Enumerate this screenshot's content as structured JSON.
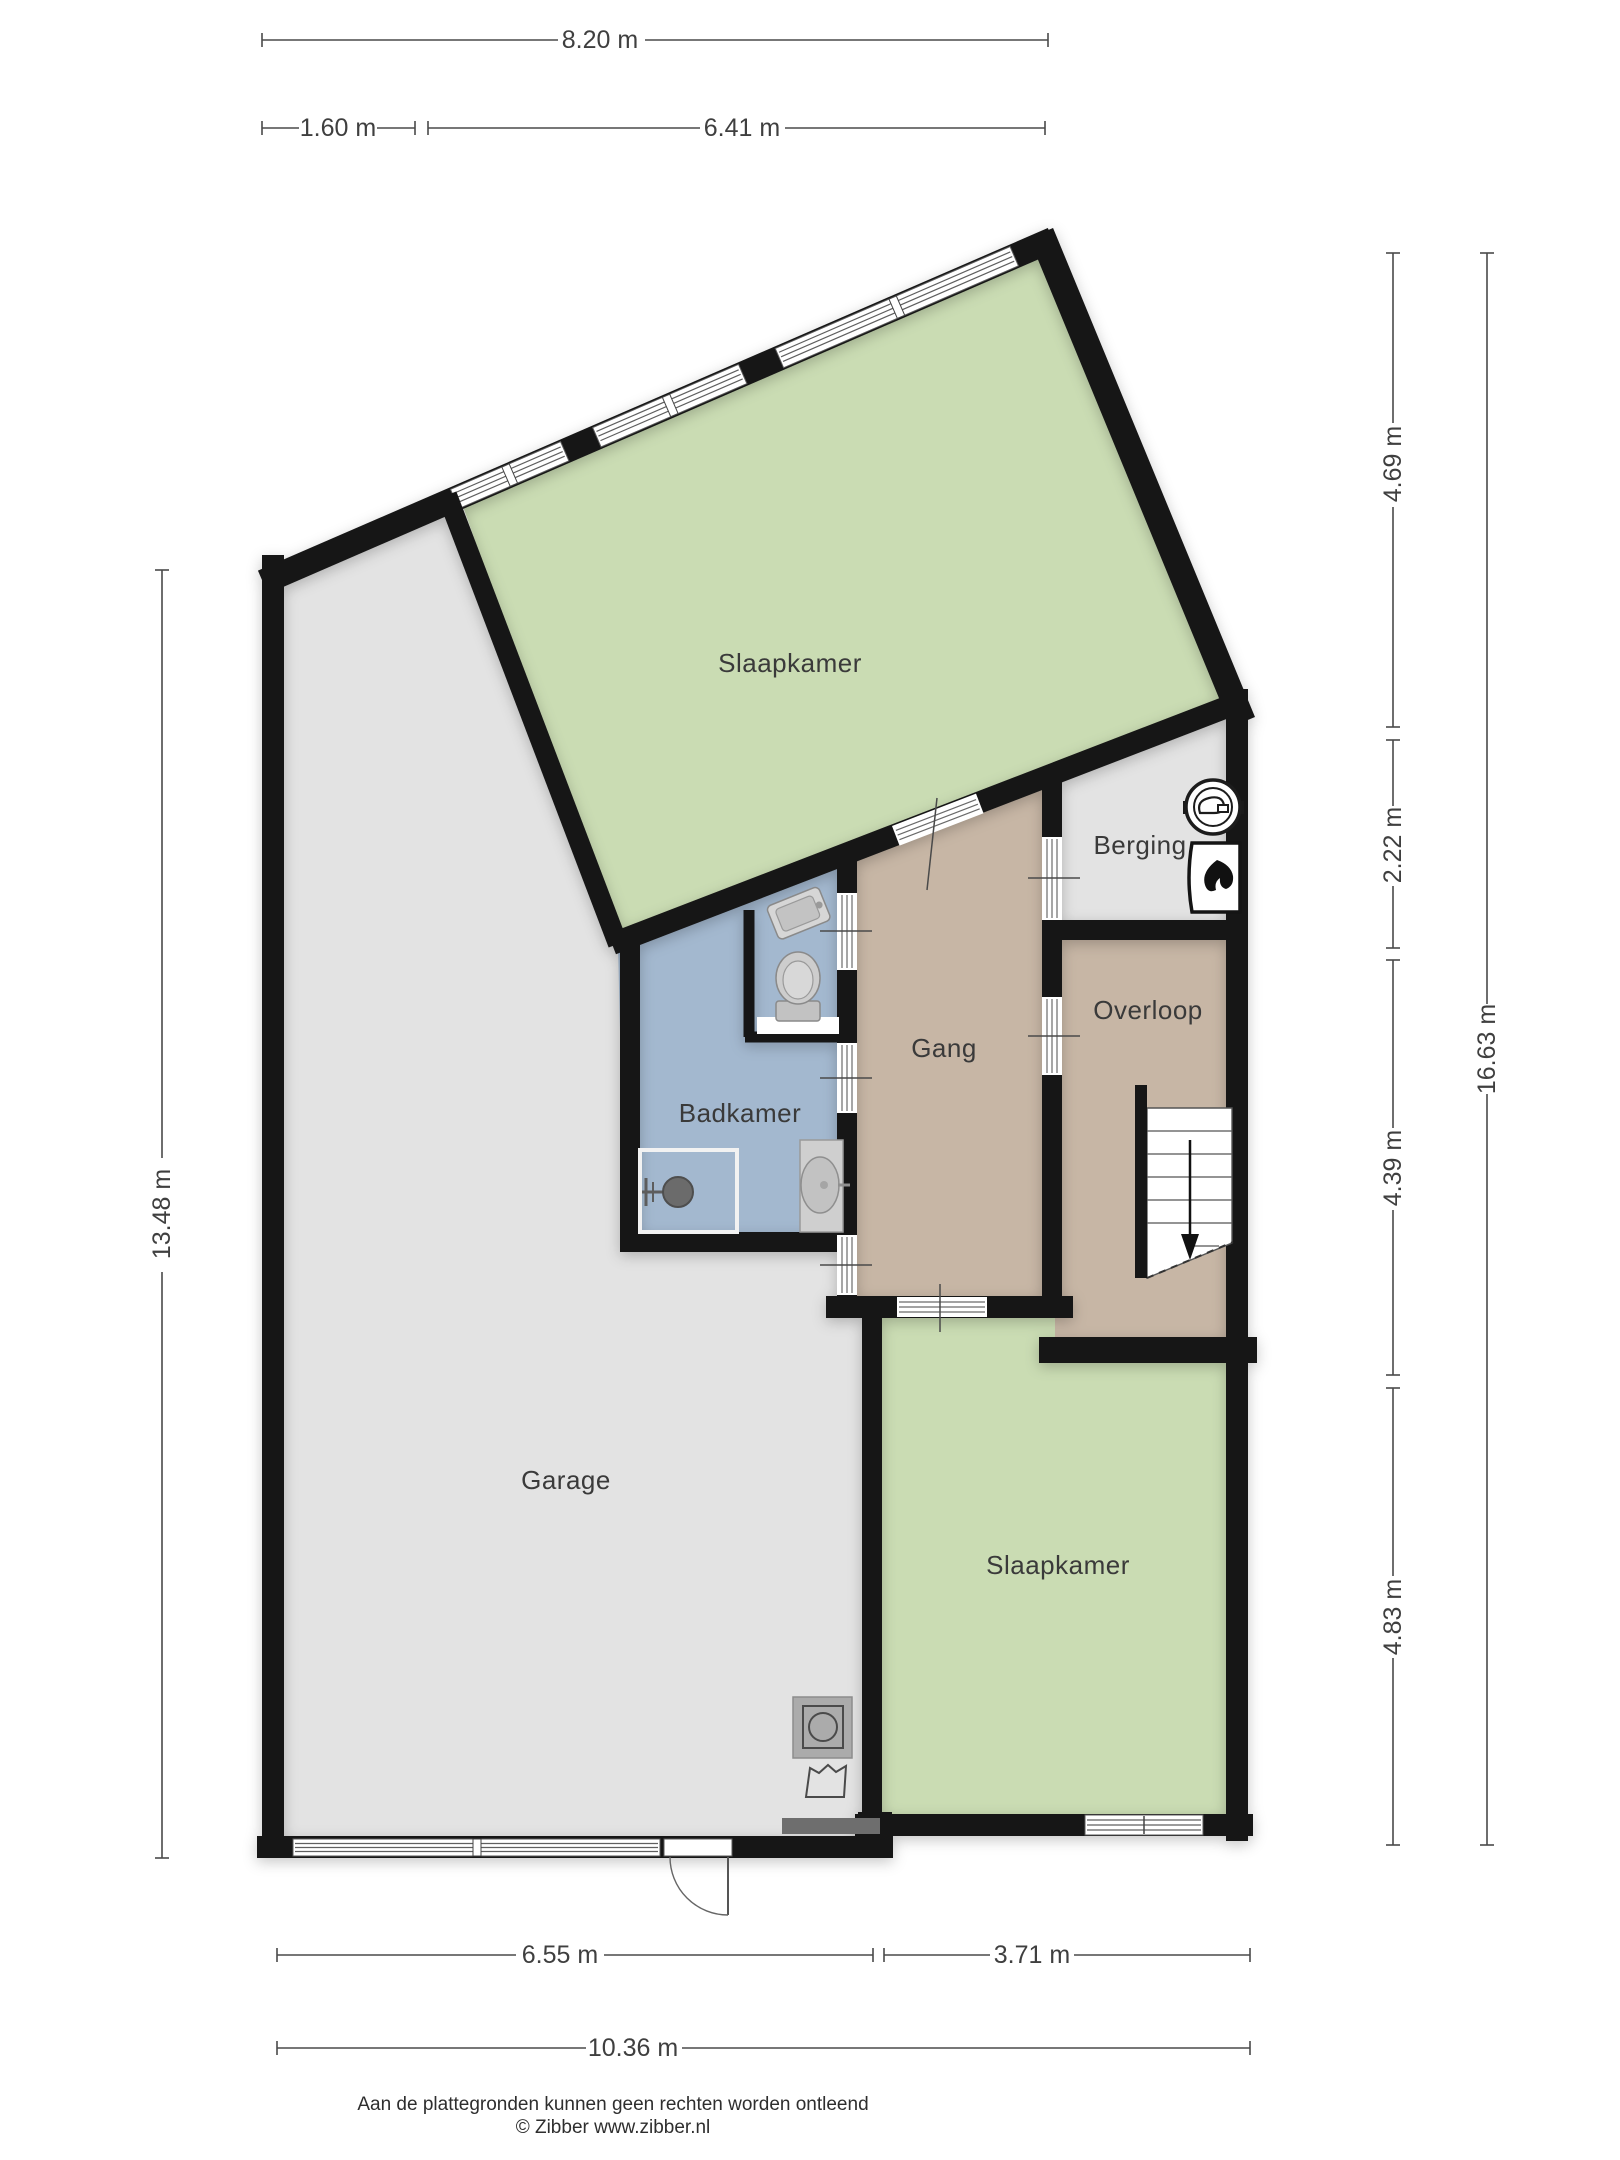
{
  "rooms": {
    "slaapkamer_top": {
      "label": "Slaapkamer"
    },
    "berging": {
      "label": "Berging"
    },
    "overloop": {
      "label": "Overloop"
    },
    "gang": {
      "label": "Gang"
    },
    "badkamer": {
      "label": "Badkamer"
    },
    "garage": {
      "label": "Garage"
    },
    "slaapkamer_bottom": {
      "label": "Slaapkamer"
    }
  },
  "dimensions": {
    "top_total": "8.20 m",
    "top_left": "1.60 m",
    "top_right": "6.41 m",
    "left_height": "13.48 m",
    "right_top": "4.69 m",
    "right_upper_mid": "2.22 m",
    "right_lower_mid": "4.39 m",
    "right_bottom": "4.83 m",
    "right_total": "16.63 m",
    "bottom_left": "6.55 m",
    "bottom_right": "3.71 m",
    "bottom_total": "10.36 m"
  },
  "footer": {
    "disclaimer": "Aan de plattegronden kunnen geen rechten worden ontleend",
    "copyright": "© Zibber www.zibber.nl"
  },
  "icons": {
    "berging_unit": "ventilation-unit-icon",
    "berging_boiler": "boiler-flame-icon",
    "badkamer_toilet": "toilet-icon",
    "badkamer_sink": "sink-icon",
    "badkamer_washbasin": "washbasin-icon",
    "badkamer_shower": "shower-icon",
    "garage_washer": "washing-machine-icon",
    "garage_basket": "laundry-basket-icon",
    "overloop_stairs": "staircase-down-icon",
    "garage_door": "entrance-door-swing-icon"
  },
  "colors": {
    "floor_green": "#cadcb3",
    "floor_gray": "#e3e3e3",
    "floor_tan": "#c7b6a5",
    "floor_blue": "#a3b8cf",
    "wall": "#161616",
    "dimension": "#4a4a4a",
    "label_text": "#3a3a3a"
  }
}
